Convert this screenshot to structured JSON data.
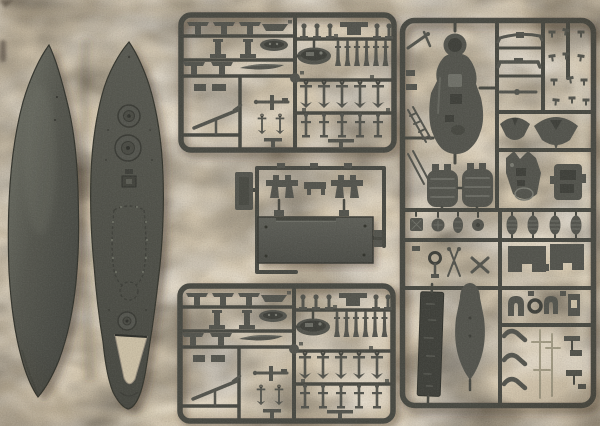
{
  "scene": {
    "type": "photograph",
    "label": "Plastic scale-model warship kit laid out on beige cloth: two hull/deck pieces and four sprues of grey parts",
    "objects": {
      "background": {
        "label": "beige cloth backdrop"
      },
      "hull": {
        "label": "ship hull half, dark grey plastic"
      },
      "deck": {
        "label": "ship deck piece with turret rings, hatches and stern cut-out"
      },
      "sprue_top": {
        "label": "sprue A: gun mounts, ship's boats, gun barrels, anchors and davits"
      },
      "sprue_middle": {
        "label": "small sprue with bridge brackets and rectangular superstructure deck plate"
      },
      "sprue_bottom": {
        "label": "sprue A duplicate: gun mounts, boats, barrels, anchors and davits"
      },
      "sprue_right": {
        "label": "sprue B: superstructure deck, funnel halves, bridge pieces, ventilators, boats, masts and nameplate"
      }
    },
    "palette": {
      "bg": "#d5c8b0",
      "bgLight": "#ece3ce",
      "bgShade": "#bdb096",
      "bgHole": "#cdc1a7",
      "plastic": "#55564f",
      "plasticDark": "#41423c",
      "plasticLight": "#7b7c73",
      "runner": "#4a4b44",
      "rod": "#a29b85",
      "shadow": "rgba(62,50,34,0.42)"
    }
  }
}
